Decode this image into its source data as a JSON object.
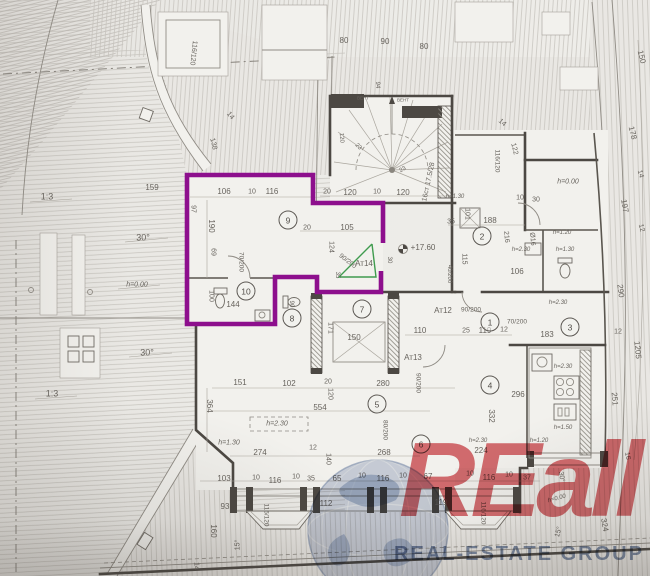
{
  "document": {
    "type": "scanned architectural floor plan with highlighted unit"
  },
  "colors": {
    "accent_purple": "#8d0f8d",
    "door_green": "#3f9b4e",
    "wm_red": "#cf3e44",
    "wm_blue": "#6c80a3",
    "ink": "#4c4843",
    "paper": "#e9e7e3"
  },
  "watermark": {
    "brand": "REall",
    "tagline": "REAL-ESTATE GROUP"
  },
  "highlighted_unit": {
    "label": "Ат14",
    "outline_color": "#8d0f8d"
  },
  "rooms": [
    {
      "n": "1",
      "x": 490,
      "y": 322
    },
    {
      "n": "2",
      "x": 482,
      "y": 236
    },
    {
      "n": "3",
      "x": 570,
      "y": 327
    },
    {
      "n": "4",
      "x": 490,
      "y": 385
    },
    {
      "n": "5",
      "x": 377,
      "y": 404
    },
    {
      "n": "6",
      "x": 421,
      "y": 444
    },
    {
      "n": "7",
      "x": 362,
      "y": 309
    },
    {
      "n": "8",
      "x": 292,
      "y": 318
    },
    {
      "n": "9",
      "x": 288,
      "y": 220
    },
    {
      "n": "10",
      "x": 246,
      "y": 291
    }
  ],
  "labels": [
    {
      "t": "116/120",
      "x": 193,
      "y": 53,
      "r": 96,
      "s": 7
    },
    {
      "t": "80",
      "x": 344,
      "y": 41
    },
    {
      "t": "90",
      "x": 385,
      "y": 42
    },
    {
      "t": "80",
      "x": 424,
      "y": 47
    },
    {
      "t": "150",
      "x": 641,
      "y": 57,
      "r": 76
    },
    {
      "t": "178",
      "x": 632,
      "y": 133,
      "r": 76
    },
    {
      "t": "ВЕНТ",
      "x": 363,
      "y": 99,
      "s": 4.5
    },
    {
      "t": "ВЕНТ",
      "x": 403,
      "y": 101,
      "s": 4.5
    },
    {
      "t": "94",
      "x": 377,
      "y": 85,
      "r": 90,
      "s": 6
    },
    {
      "t": "14",
      "x": 230,
      "y": 116,
      "r": 50,
      "s": 7
    },
    {
      "t": "138",
      "x": 213,
      "y": 144,
      "r": 76,
      "s": 7
    },
    {
      "t": "14",
      "x": 502,
      "y": 123,
      "r": 40,
      "s": 7
    },
    {
      "t": "122",
      "x": 514,
      "y": 149,
      "r": 76,
      "s": 7
    },
    {
      "t": "16ст 17.5/28",
      "x": 429,
      "y": 182,
      "r": -78,
      "s": 7
    },
    {
      "t": "23",
      "x": 358,
      "y": 147,
      "r": 45,
      "s": 6
    },
    {
      "t": "23",
      "x": 403,
      "y": 170,
      "r": -30,
      "s": 6
    },
    {
      "t": "120",
      "x": 341,
      "y": 138,
      "r": 85,
      "s": 6
    },
    {
      "t": "1:3",
      "x": 47,
      "y": 197,
      "s": 9
    },
    {
      "t": "30°",
      "x": 143,
      "y": 238,
      "s": 9
    },
    {
      "t": "1:3",
      "x": 52,
      "y": 394,
      "s": 9
    },
    {
      "t": "30°",
      "x": 147,
      "y": 353,
      "s": 9
    },
    {
      "t": "h=0.00",
      "x": 137,
      "y": 285,
      "s": 7,
      "i": true
    },
    {
      "t": "159",
      "x": 152,
      "y": 188
    },
    {
      "t": "97",
      "x": 193,
      "y": 209,
      "r": 90,
      "s": 7
    },
    {
      "t": "106",
      "x": 224,
      "y": 192
    },
    {
      "t": "10",
      "x": 252,
      "y": 192,
      "s": 7
    },
    {
      "t": "116",
      "x": 272,
      "y": 192
    },
    {
      "t": "190",
      "x": 211,
      "y": 226,
      "r": 90
    },
    {
      "t": "69",
      "x": 213,
      "y": 252,
      "r": 90,
      "s": 7
    },
    {
      "t": "70/200",
      "x": 240,
      "y": 262,
      "r": 90,
      "s": 6.5
    },
    {
      "t": "20",
      "x": 307,
      "y": 228,
      "s": 7
    },
    {
      "t": "105",
      "x": 347,
      "y": 228
    },
    {
      "t": "20",
      "x": 327,
      "y": 192,
      "s": 7
    },
    {
      "t": "120",
      "x": 350,
      "y": 193
    },
    {
      "t": "10",
      "x": 377,
      "y": 192,
      "s": 7
    },
    {
      "t": "120",
      "x": 403,
      "y": 193
    },
    {
      "t": "124",
      "x": 331,
      "y": 247,
      "r": 90,
      "s": 7
    },
    {
      "t": "90/200",
      "x": 347,
      "y": 262,
      "r": 38,
      "s": 6.5
    },
    {
      "t": "Ат14",
      "x": 364,
      "y": 264,
      "s": 8
    },
    {
      "t": "35",
      "x": 337,
      "y": 275,
      "r": 90,
      "s": 6
    },
    {
      "t": "30",
      "x": 389,
      "y": 260,
      "r": 90,
      "s": 6
    },
    {
      "t": "100",
      "x": 211,
      "y": 296,
      "r": 90,
      "s": 7
    },
    {
      "t": "144",
      "x": 233,
      "y": 305
    },
    {
      "t": "90",
      "x": 291,
      "y": 304,
      "r": 90,
      "s": 6
    },
    {
      "t": "171",
      "x": 330,
      "y": 328,
      "r": 90,
      "s": 7
    },
    {
      "t": "150",
      "x": 354,
      "y": 338
    },
    {
      "t": "110",
      "x": 420,
      "y": 331
    },
    {
      "t": "25",
      "x": 466,
      "y": 331,
      "s": 7
    },
    {
      "t": "119",
      "x": 485,
      "y": 331
    },
    {
      "t": "12",
      "x": 504,
      "y": 330,
      "s": 7
    },
    {
      "t": "70/200",
      "x": 517,
      "y": 323,
      "s": 6.5
    },
    {
      "t": "Ат12",
      "x": 443,
      "y": 311
    },
    {
      "t": "90/200",
      "x": 471,
      "y": 311,
      "s": 6.5
    },
    {
      "t": "Ат13",
      "x": 413,
      "y": 358
    },
    {
      "t": "90/200",
      "x": 417,
      "y": 383,
      "r": 90,
      "s": 6.5
    },
    {
      "t": "183",
      "x": 547,
      "y": 335
    },
    {
      "t": "h=2.30",
      "x": 558,
      "y": 303,
      "s": 6,
      "i": true
    },
    {
      "t": "h=1.30",
      "x": 455,
      "y": 197,
      "s": 6,
      "i": true
    },
    {
      "t": "101",
      "x": 467,
      "y": 214,
      "r": 90,
      "s": 7
    },
    {
      "t": "35",
      "x": 451,
      "y": 222,
      "s": 7
    },
    {
      "t": "188",
      "x": 490,
      "y": 221
    },
    {
      "t": "10",
      "x": 520,
      "y": 198,
      "s": 7
    },
    {
      "t": "30",
      "x": 536,
      "y": 200,
      "s": 7
    },
    {
      "t": "216",
      "x": 506,
      "y": 237,
      "r": 85,
      "s": 7
    },
    {
      "t": "Ø16",
      "x": 532,
      "y": 239,
      "r": 85,
      "s": 7
    },
    {
      "t": "h=2.30",
      "x": 521,
      "y": 250,
      "s": 6,
      "i": true
    },
    {
      "t": "+17.60",
      "x": 423,
      "y": 248,
      "s": 8
    },
    {
      "t": "115",
      "x": 464,
      "y": 259,
      "r": 90,
      "s": 7
    },
    {
      "t": "40/200",
      "x": 449,
      "y": 274,
      "r": 90,
      "s": 6
    },
    {
      "t": "106",
      "x": 517,
      "y": 272
    },
    {
      "t": "116/120",
      "x": 496,
      "y": 161,
      "r": 90,
      "s": 6.5
    },
    {
      "t": "h=0.00",
      "x": 568,
      "y": 182,
      "s": 7,
      "i": true
    },
    {
      "t": "h=1.20",
      "x": 562,
      "y": 233,
      "s": 6,
      "i": true
    },
    {
      "t": "h=1.30",
      "x": 565,
      "y": 250,
      "s": 6,
      "i": true
    },
    {
      "t": "14",
      "x": 640,
      "y": 174,
      "r": 76,
      "s": 7
    },
    {
      "t": "197",
      "x": 624,
      "y": 206,
      "r": 80
    },
    {
      "t": "12",
      "x": 641,
      "y": 228,
      "r": 76,
      "s": 7
    },
    {
      "t": "290",
      "x": 620,
      "y": 291,
      "r": 83
    },
    {
      "t": "12",
      "x": 618,
      "y": 332,
      "s": 7
    },
    {
      "t": "1205",
      "x": 637,
      "y": 350,
      "r": 85
    },
    {
      "t": "251",
      "x": 614,
      "y": 399,
      "r": 85
    },
    {
      "t": "151",
      "x": 240,
      "y": 383
    },
    {
      "t": "102",
      "x": 289,
      "y": 384
    },
    {
      "t": "20",
      "x": 328,
      "y": 382,
      "s": 7
    },
    {
      "t": "280",
      "x": 383,
      "y": 384
    },
    {
      "t": "120",
      "x": 330,
      "y": 394,
      "r": 90,
      "s": 7
    },
    {
      "t": "554",
      "x": 320,
      "y": 408
    },
    {
      "t": "364",
      "x": 209,
      "y": 406,
      "r": 90
    },
    {
      "t": "296",
      "x": 518,
      "y": 395
    },
    {
      "t": "332",
      "x": 491,
      "y": 416,
      "r": 90
    },
    {
      "t": "h=2.30",
      "x": 563,
      "y": 367,
      "s": 6,
      "i": true
    },
    {
      "t": "h=1.50",
      "x": 563,
      "y": 428,
      "s": 6,
      "i": true
    },
    {
      "t": "h=1.20",
      "x": 539,
      "y": 441,
      "s": 6,
      "i": true
    },
    {
      "t": "h=2.30",
      "x": 277,
      "y": 424,
      "s": 7,
      "i": true
    },
    {
      "t": "h=1.30",
      "x": 229,
      "y": 443,
      "s": 7,
      "i": true
    },
    {
      "t": "274",
      "x": 260,
      "y": 453
    },
    {
      "t": "12",
      "x": 313,
      "y": 448,
      "s": 7
    },
    {
      "t": "140",
      "x": 328,
      "y": 459,
      "r": 90,
      "s": 7
    },
    {
      "t": "80/200",
      "x": 384,
      "y": 430,
      "r": 90,
      "s": 6.5
    },
    {
      "t": "268",
      "x": 384,
      "y": 453
    },
    {
      "t": "h=2.30",
      "x": 478,
      "y": 441,
      "s": 6,
      "i": true
    },
    {
      "t": "224",
      "x": 481,
      "y": 451
    },
    {
      "t": "103",
      "x": 224,
      "y": 479
    },
    {
      "t": "10",
      "x": 256,
      "y": 478,
      "s": 7
    },
    {
      "t": "116",
      "x": 275,
      "y": 481
    },
    {
      "t": "10",
      "x": 296,
      "y": 477,
      "s": 7
    },
    {
      "t": "35",
      "x": 311,
      "y": 479,
      "s": 7
    },
    {
      "t": "65",
      "x": 337,
      "y": 479
    },
    {
      "t": "10",
      "x": 362,
      "y": 476,
      "s": 7
    },
    {
      "t": "116",
      "x": 383,
      "y": 479
    },
    {
      "t": "10",
      "x": 403,
      "y": 476,
      "s": 7
    },
    {
      "t": "67",
      "x": 428,
      "y": 477
    },
    {
      "t": "10",
      "x": 470,
      "y": 474,
      "s": 7
    },
    {
      "t": "116",
      "x": 489,
      "y": 478
    },
    {
      "t": "10",
      "x": 509,
      "y": 475,
      "s": 7
    },
    {
      "t": "37",
      "x": 527,
      "y": 478,
      "s": 7
    },
    {
      "t": "93",
      "x": 225,
      "y": 507
    },
    {
      "t": "112",
      "x": 326,
      "y": 504
    },
    {
      "t": "119",
      "x": 441,
      "y": 503
    },
    {
      "t": "116/120",
      "x": 265,
      "y": 515,
      "r": 90,
      "s": 6.5
    },
    {
      "t": "116/120",
      "x": 482,
      "y": 513,
      "r": 90,
      "s": 6.5
    },
    {
      "t": "160",
      "x": 213,
      "y": 531,
      "r": 90
    },
    {
      "t": "15°",
      "x": 238,
      "y": 545,
      "r": -90,
      "s": 7
    },
    {
      "t": "15°",
      "x": 559,
      "y": 532,
      "r": -75,
      "s": 7
    },
    {
      "t": "30°",
      "x": 561,
      "y": 477,
      "r": 80,
      "s": 7
    },
    {
      "t": "324",
      "x": 604,
      "y": 525,
      "r": 80
    },
    {
      "t": "16",
      "x": 627,
      "y": 456,
      "r": 80,
      "s": 7
    },
    {
      "t": "14",
      "x": 196,
      "y": 566,
      "r": 90,
      "s": 7
    },
    {
      "t": "h=0.00",
      "x": 557,
      "y": 499,
      "r": -15,
      "s": 6,
      "i": true
    }
  ]
}
